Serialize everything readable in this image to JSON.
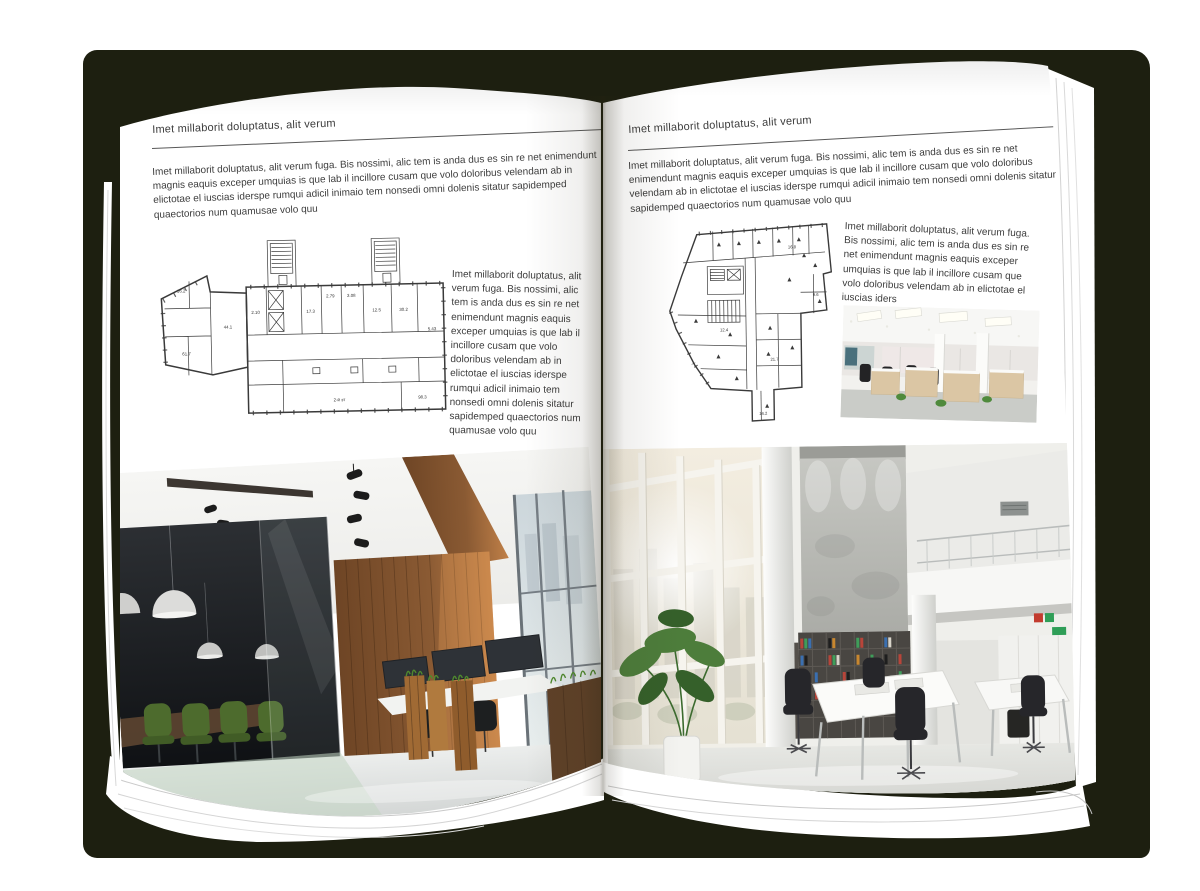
{
  "document": {
    "type": "interior-design-brochure-spread",
    "colors": {
      "backdrop": "#1d1f10",
      "page": "#ffffff",
      "body_text": "#3b3b3b",
      "rule": "#585858",
      "plan_line": "#3a3a3a",
      "wood": "#8a5a33",
      "meeting_room_dark": "#141619",
      "chair_green": "#4d6b2d",
      "concrete_wall": "#b9bab5",
      "binder_red": "#b8453a",
      "binder_green": "#3f9d5a",
      "binder_blue": "#3a6fb0"
    }
  },
  "pages": {
    "left": {
      "header": "Imet millaborit doluptatus, alit verum",
      "intro": "Imet millaborit doluptatus, alit verum fuga. Bis nossimi, alic tem is anda dus es sin re net enimendunt magnis eaquis exceper umquias is que lab il incillore cusam que volo doloribus velendam ab in elictotae el iuscias iderspe rumqui adicil inimaio tem nonsedi omni dolenis sitatur sapidemped quaectorios num quamusae volo quu",
      "side_text": "Imet millaborit doluptatus, alit verum fuga. Bis nossimi, alic tem is anda dus es sin re net enimendunt magnis eaquis exceper umquias is que lab il incillore cusam que volo doloribus velendam ab in elictotae el iuscias iderspe rumqui adicil inimaio tem nonsedi omni dolenis sitatur sapidemped quaectorios num quamusae volo quu",
      "plan_labels": {
        "a": "17.3",
        "b": "2.79",
        "c": "3.08",
        "d": "12.5",
        "e": "30.2",
        "f": "16.2",
        "g": "44.1",
        "h": "61.7",
        "i": "98.3",
        "j": "2-й эт",
        "k": "2.10",
        "l": "5.43"
      }
    },
    "right": {
      "header": "Imet millaborit doluptatus, alit verum",
      "intro": "Imet millaborit doluptatus, alit verum fuga. Bis nossimi, alic tem is anda dus es sin re net enimendunt magnis eaquis exceper umquias is que lab il incillore cusam que volo doloribus velendam ab in elictotae el iuscias iderspe rumqui adicil inimaio tem nonsedi omni dolenis sitatur sapidemped quaectorios num quamusae volo quu",
      "side_text": "Imet millaborit doluptatus, alit verum fuga. Bis nossimi, alic tem is anda dus es sin re net enimendunt magnis eaquis exceper umquias is que lab il incillore cusam que volo doloribus velendam ab in elictotae el iuscias iders",
      "plan_labels": {
        "a": "16.8",
        "b": "12.4",
        "c": "21.7",
        "d": "9.6",
        "e": "14.2"
      }
    }
  }
}
